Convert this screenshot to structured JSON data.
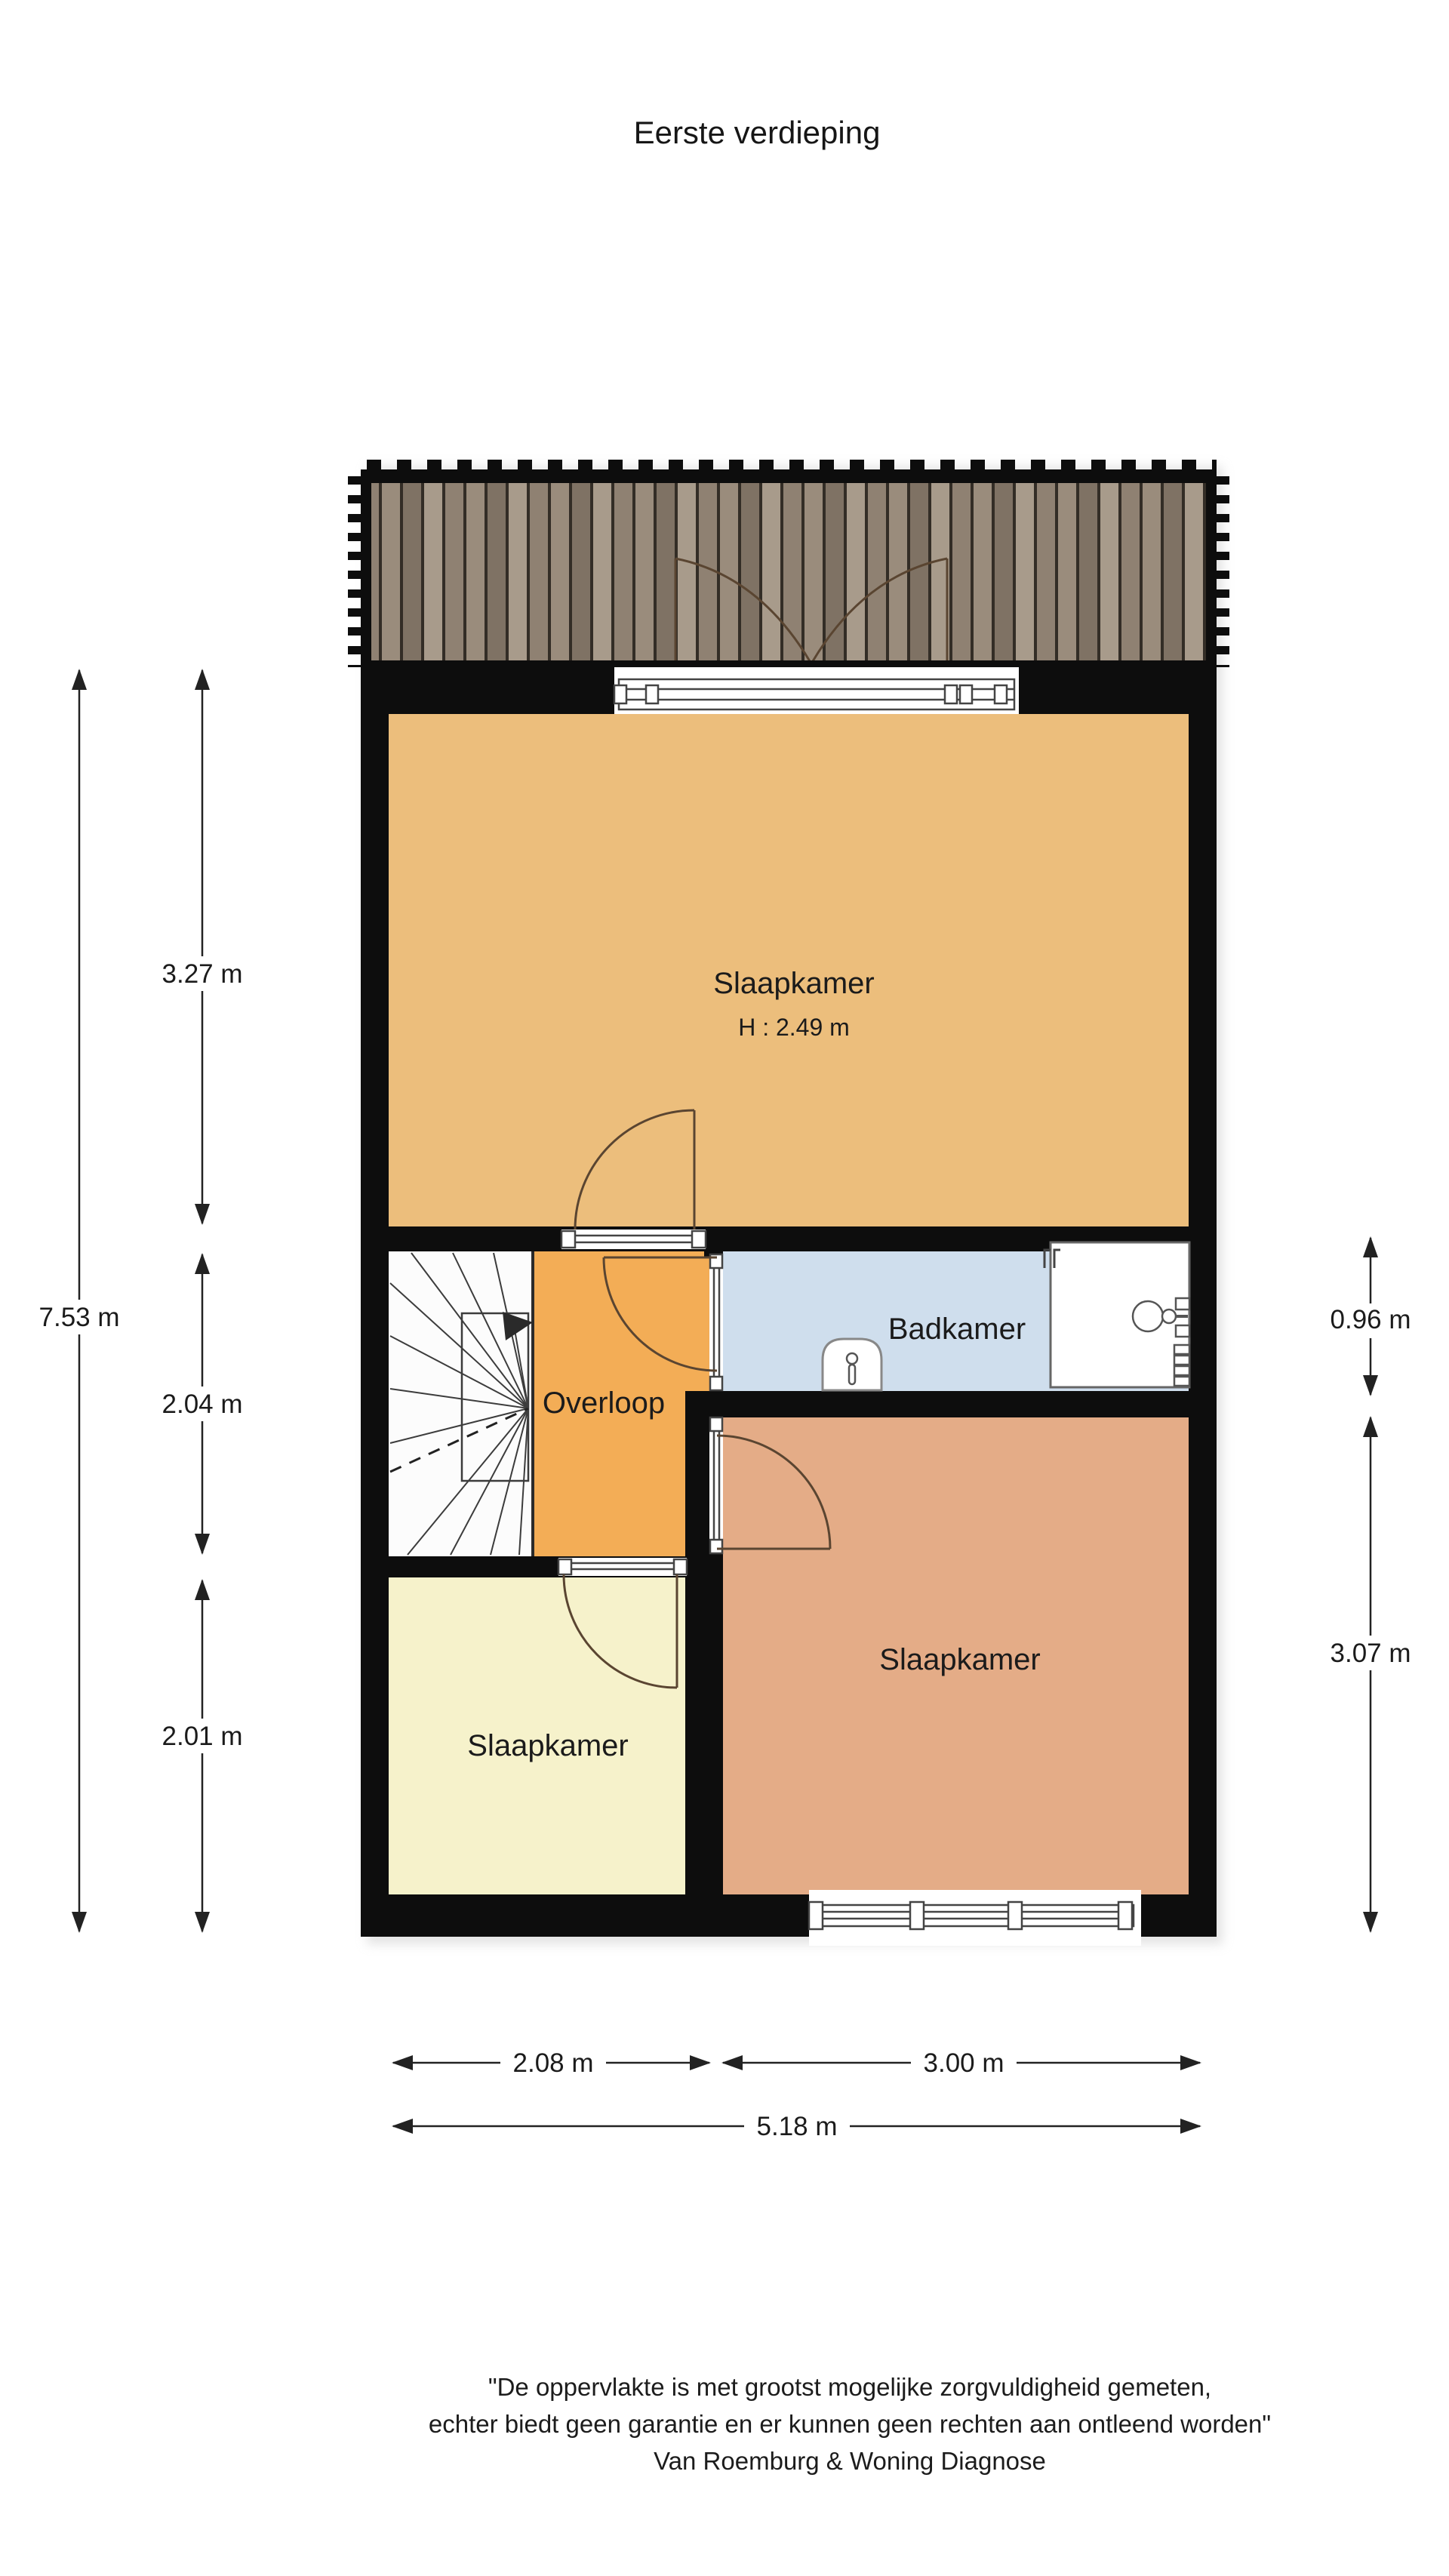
{
  "title": "Eerste verdieping",
  "floor_plan": {
    "rooms": {
      "bedroom_main": {
        "label": "Slaapkamer",
        "ceiling_height": "H : 2.49 m",
        "color": "#ecbe7c"
      },
      "landing": {
        "label": "Overloop",
        "color": "#f3ad56"
      },
      "bathroom": {
        "label": "Badkamer",
        "color": "#cfdeed"
      },
      "bedroom_small": {
        "label": "Slaapkamer",
        "color": "#f6f2cb"
      },
      "bedroom_back": {
        "label": "Slaapkamer",
        "color": "#e4ac87"
      },
      "stairs": {
        "color": "#fcfcfc"
      }
    },
    "wall_color": "#0d0d0d",
    "deck_plank_colors": [
      "#a89b8b",
      "#8f8172",
      "#9a8c7c",
      "#7f7264"
    ],
    "icon_names": [
      "balcony-deck-icon",
      "double-door-icon",
      "winder-stairs-icon",
      "shower-icon",
      "toilet-icon",
      "radiator-icon",
      "window-icon",
      "door-swing-icon"
    ]
  },
  "dimensions": {
    "total_height": "7.53 m",
    "bedroom_main_depth": "3.27 m",
    "landing_depth": "2.04 m",
    "bedroom_small_depth": "2.01 m",
    "bathroom_depth": "0.96 m",
    "bedroom_back_depth": "3.07 m",
    "width_left": "2.08 m",
    "width_right": "3.00 m",
    "total_width": "5.18 m"
  },
  "disclaimer": {
    "line1": "\"De oppervlakte is met grootst mogelijke zorgvuldigheid gemeten,",
    "line2": "echter biedt geen garantie en er kunnen geen rechten aan ontleend worden\"",
    "line3": "Van Roemburg & Woning Diagnose"
  }
}
